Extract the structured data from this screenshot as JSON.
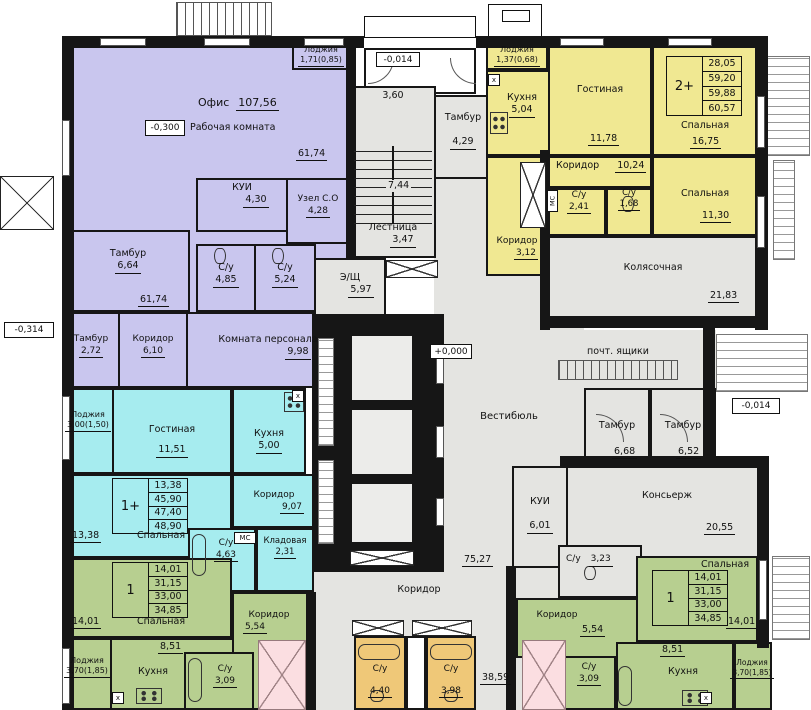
{
  "colors": {
    "office_purple": "#c9c6ee",
    "apartment_yellow": "#f0e892",
    "apartment_cyan": "#a6ecef",
    "apartment_green": "#b7cf90",
    "wc_orange": "#efc878",
    "cutoff_pink": "#f8c3c9",
    "common_gray": "#e4e4e1",
    "wall_black": "#161616"
  },
  "levels": {
    "office": "-0,300",
    "entry": "-0,014",
    "vestibule": "+0,000",
    "left": "-0,314",
    "right": "-0,014"
  },
  "office": {
    "name": "Офис",
    "area": "107,56",
    "workroom": "Рабочая комната",
    "workroom_area1": "61,74",
    "workroom_area2": "61,74",
    "loggia": {
      "name": "Лоджия",
      "area": "1,71(0,85)"
    },
    "kui": {
      "name": "КУИ",
      "area": "4,30"
    },
    "unit_co": {
      "name": "Узел С.О",
      "area": "4,28"
    },
    "wc1": {
      "name": "С/у",
      "area": "4,85"
    },
    "wc2": {
      "name": "С/у",
      "area": "5,24"
    },
    "tambour1": {
      "name": "Тамбур",
      "area": "6,64"
    },
    "tambour2": {
      "name": "Тамбур",
      "area": "2,72"
    },
    "corridor": {
      "name": "Коридор",
      "area": "6,10"
    },
    "staff": {
      "name": "Комната персонала",
      "area": "9,98"
    }
  },
  "stair": {
    "upper_area": "3,60",
    "flight_area": "7,44",
    "name": "Лестница",
    "area": "3,47"
  },
  "entry_tambour": {
    "name": "Тамбур",
    "area": "4,29"
  },
  "esh": {
    "name": "Э/Щ",
    "area": "5,97"
  },
  "apt_2plus": {
    "type": "2+",
    "stats": [
      "28,05",
      "59,20",
      "59,88",
      "60,57"
    ],
    "loggia": {
      "name": "Лоджия",
      "area": "1,37(0,68)"
    },
    "kitchen": {
      "name": "Кухня",
      "area": "5,04"
    },
    "living": {
      "name": "Гостиная",
      "area": "11,78"
    },
    "bedroom1": {
      "name": "Спальная",
      "area": "16,75"
    },
    "bedroom2": {
      "name": "Спальная",
      "area": "11,30"
    },
    "corridor1": {
      "name": "Коридор",
      "area": "10,24"
    },
    "corridor2": {
      "name": "Коридор",
      "area": "3,12"
    },
    "wc1": {
      "name": "С/у",
      "area": "2,41"
    },
    "wc2": {
      "name": "С/у",
      "area": "1,68"
    }
  },
  "common": {
    "stroller": {
      "name": "Колясочная",
      "area": "21,83"
    },
    "mailboxes": "почт. ящики",
    "vestibule": {
      "name": "Вестибюль",
      "area": "75,27"
    },
    "tambour1": {
      "name": "Тамбур",
      "area": "6,68"
    },
    "tambour2": {
      "name": "Тамбур",
      "area": "6,52"
    },
    "concierge": {
      "name": "Консьерж",
      "area": "20,55"
    },
    "kui": {
      "name": "КУИ",
      "area": "6,01"
    },
    "wc": {
      "name": "С/у",
      "area": "3,23"
    },
    "corridor": {
      "name": "Коридор",
      "area": "38,59"
    },
    "wc_left": {
      "name": "С/у",
      "area": "4,40"
    },
    "wc_right": {
      "name": "С/у",
      "area": "3,98"
    }
  },
  "apt_1plus": {
    "type": "1+",
    "stats": [
      "13,38",
      "45,90",
      "47,40",
      "48,90"
    ],
    "loggia": {
      "name": "Лоджия",
      "area": "3,00(1,50)"
    },
    "living": {
      "name": "Гостиная",
      "area": "11,51"
    },
    "kitchen": {
      "name": "Кухня",
      "area": "5,00"
    },
    "bedroom": {
      "name": "Спальная",
      "area": "13,38"
    },
    "corridor": {
      "name": "Коридор",
      "area": "9,07"
    },
    "wc": {
      "name": "С/у",
      "area": "4,63"
    },
    "storage": {
      "name": "Кладовая",
      "area": "2,31"
    }
  },
  "apt_1_left": {
    "type": "1",
    "stats": [
      "14,01",
      "31,15",
      "33,00",
      "34,85"
    ],
    "bedroom": {
      "name": "Спальная",
      "area": "14,01"
    },
    "kitchen": {
      "name": "Кухня",
      "area": "8,51"
    },
    "loggia": {
      "name": "Лоджия",
      "area": "3,70(1,85)"
    },
    "corridor": {
      "name": "Коридор",
      "area": "5,54"
    },
    "wc": {
      "name": "С/у",
      "area": "3,09"
    }
  },
  "apt_1_right": {
    "type": "1",
    "stats": [
      "14,01",
      "31,15",
      "33,00",
      "34,85"
    ],
    "bedroom": {
      "name": "Спальная",
      "area": "14,01"
    },
    "kitchen": {
      "name": "Кухня",
      "area": "8,51"
    },
    "loggia": {
      "name": "Лоджия",
      "area": "3,70(1,85)"
    },
    "corridor": {
      "name": "Коридор",
      "area": "5,54"
    },
    "wc": {
      "name": "С/у",
      "area": "3,09"
    }
  },
  "marks": {
    "mc": "МС",
    "washer": "х",
    "arrow_down": "↓"
  }
}
